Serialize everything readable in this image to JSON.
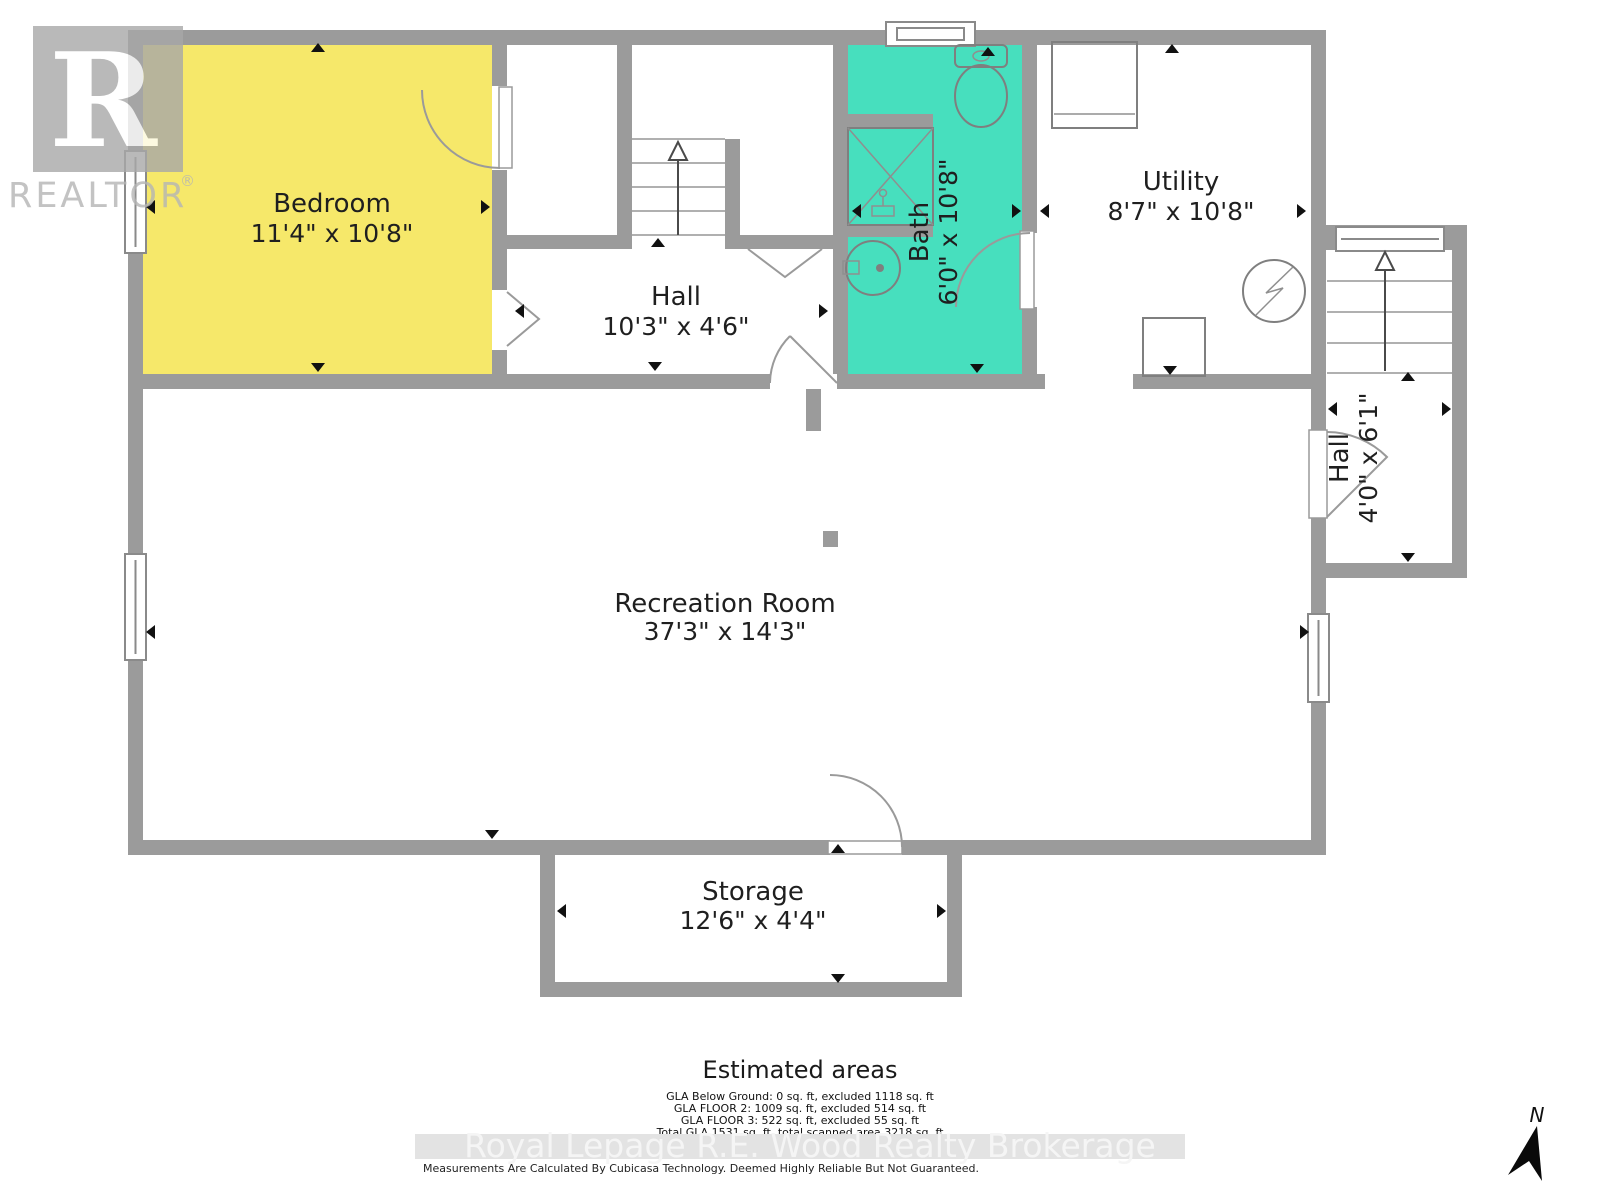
{
  "branding": {
    "logo_letter": "R",
    "logo_name": "REALTOR",
    "logo_reg": "®"
  },
  "rooms": {
    "bedroom": {
      "name": "Bedroom",
      "dims": "11'4\" x 10'8\""
    },
    "hall": {
      "name": "Hall",
      "dims": "10'3\" x 4'6\""
    },
    "bath": {
      "name": "Bath",
      "dims": "6'0\" x 10'8\""
    },
    "utility": {
      "name": "Utility",
      "dims": "8'7\" x 10'8\""
    },
    "hall_right": {
      "name": "Hall",
      "dims": "4'0\" x 6'1\""
    },
    "recreation": {
      "name": "Recreation Room",
      "dims": "37'3\" x 14'3\""
    },
    "storage": {
      "name": "Storage",
      "dims": "12'6\" x 4'4\""
    }
  },
  "estimated": {
    "title": "Estimated areas",
    "lines": [
      "GLA Below Ground: 0 sq. ft, excluded 1118 sq. ft",
      "GLA FLOOR 2: 1009 sq. ft, excluded 514 sq. ft",
      "GLA FLOOR 3: 522 sq. ft, excluded 55 sq. ft",
      "Total GLA 1531 sq. ft, total scanned area 3218 sq. ft"
    ]
  },
  "watermark": "Royal Lepage R.E. Wood Realty Brokerage",
  "disclaimer": "Measurements Are Calculated By Cubicasa Technology. Deemed Highly Reliable But Not Guaranteed.",
  "compass": {
    "north_label": "N"
  },
  "colors": {
    "wall": "#9B9B9B",
    "bedroom_fill": "#F6E86A",
    "bath_fill": "#47DFBE",
    "marker": "#111111",
    "watermark_band": "#e3e3e3"
  }
}
